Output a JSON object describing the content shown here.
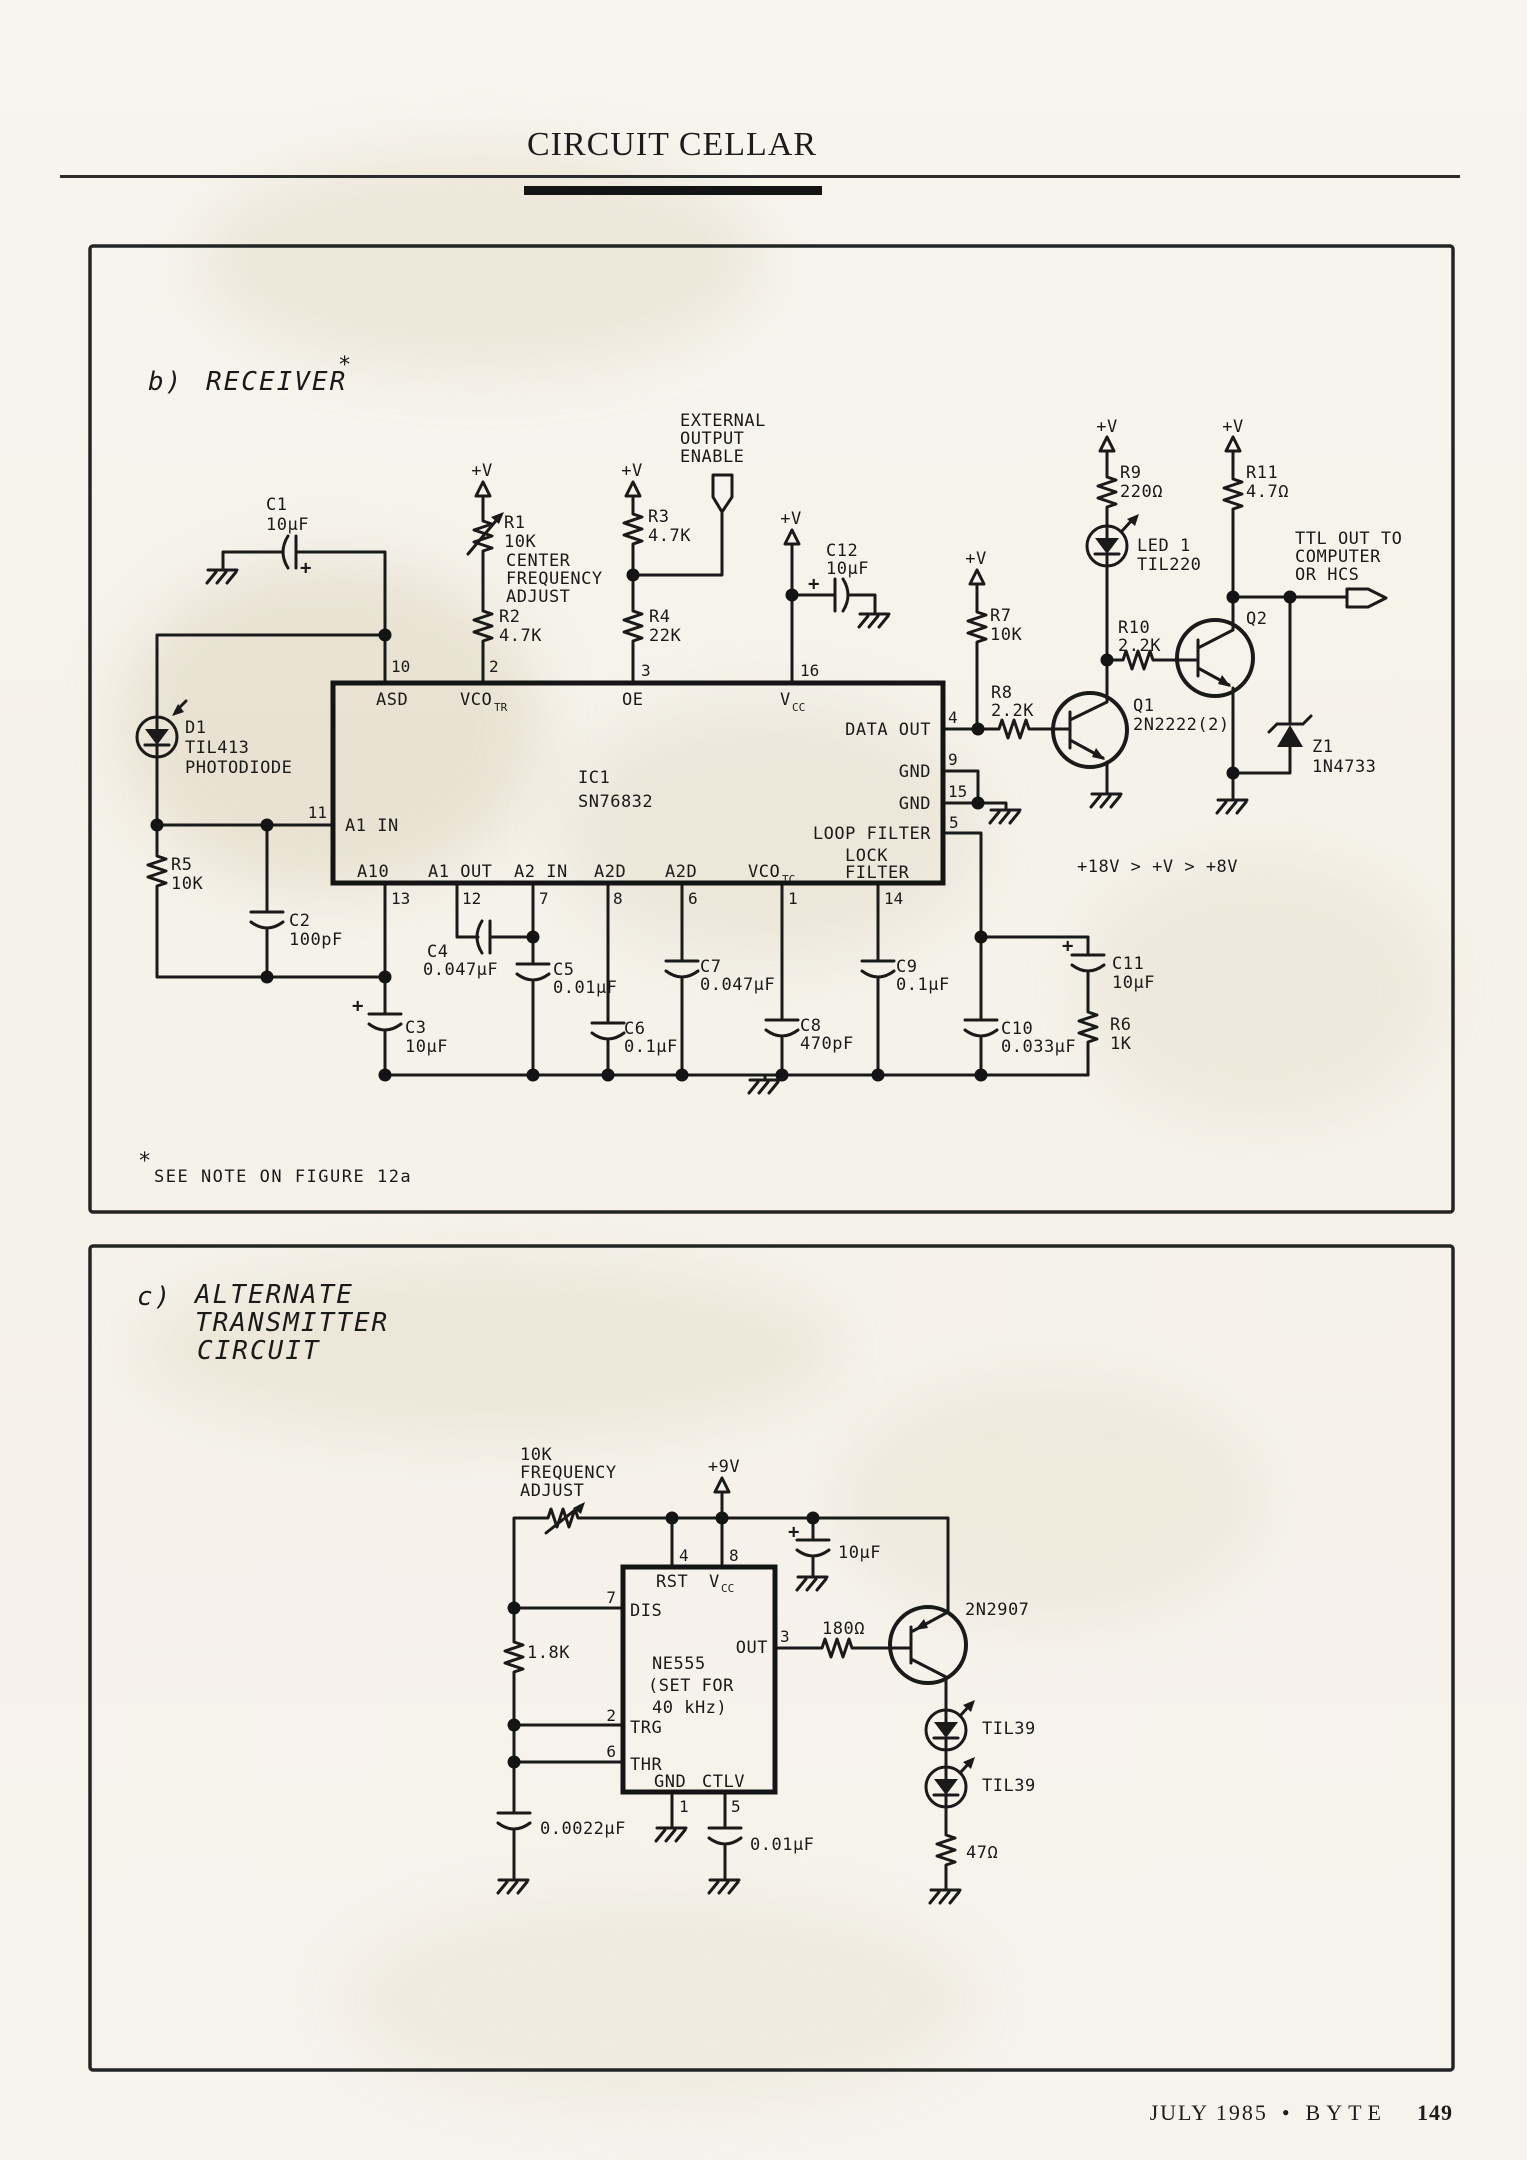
{
  "header": {
    "title": "CIRCUIT CELLAR"
  },
  "footer": {
    "issue": "JULY 1985",
    "bullet": "•",
    "magazine": "BYTE",
    "page": "149"
  },
  "shared": {
    "plus_v": "+V",
    "plus": "+"
  },
  "rx": {
    "title_prefix": "b)",
    "title": "RECEIVER",
    "star": "*",
    "note_star": "*",
    "note": "SEE NOTE ON FIGURE 12a",
    "voltage_note": "+18V > +V > +8V",
    "enable1": "EXTERNAL",
    "enable2": "OUTPUT",
    "enable3": "ENABLE",
    "ttl1": "TTL OUT TO",
    "ttl2": "COMPUTER",
    "ttl3": "OR HCS",
    "ic_ref": "IC1",
    "ic_part": "SN76832",
    "pn": {
      "p10": "10",
      "p2": "2",
      "p3": "3",
      "p16": "16",
      "p11": "11",
      "p4": "4",
      "p9": "9",
      "p15": "15",
      "p5": "5",
      "p13": "13",
      "p12": "12",
      "p7": "7",
      "p8": "8",
      "p6": "6",
      "p1": "1",
      "p14": "14"
    },
    "pl": {
      "asd": "ASD",
      "vco": "VCO",
      "tr": "TR",
      "oe": "OE",
      "v": "V",
      "cc": "CC",
      "a1in": "A1 IN",
      "dataout": "DATA OUT",
      "gnd": "GND",
      "loop": "LOOP FILTER",
      "lock1": "LOCK",
      "lock2": "FILTER",
      "a10": "A10",
      "a1out": "A1 OUT",
      "a2in": "A2 IN",
      "a2d": "A2D",
      "tc": "TC"
    },
    "c1": {
      "r": "C1",
      "v": "10μF"
    },
    "r1": {
      "r": "R1",
      "v": "10K",
      "n1": "CENTER",
      "n2": "FREQUENCY",
      "n3": "ADJUST"
    },
    "r2": {
      "r": "R2",
      "v": "4.7K"
    },
    "r3": {
      "r": "R3",
      "v": "4.7K"
    },
    "r4": {
      "r": "R4",
      "v": "22K"
    },
    "c12": {
      "r": "C12",
      "v": "10μF"
    },
    "r7": {
      "r": "R7",
      "v": "10K"
    },
    "r8": {
      "r": "R8",
      "v": "2.2K"
    },
    "r9": {
      "r": "R9",
      "v": "220Ω"
    },
    "r10": {
      "r": "R10",
      "v": "2.2K"
    },
    "r11": {
      "r": "R11",
      "v": "4.7Ω"
    },
    "led1": {
      "r": "LED 1",
      "v": "TIL220"
    },
    "q1": {
      "r": "Q1",
      "v": "2N2222(2)"
    },
    "q2": {
      "r": "Q2"
    },
    "z1": {
      "r": "Z1",
      "v": "1N4733"
    },
    "d1": {
      "r": "D1",
      "v": "TIL413",
      "n": "PHOTODIODE"
    },
    "r5": {
      "r": "R5",
      "v": "10K"
    },
    "c2": {
      "r": "C2",
      "v": "100pF"
    },
    "c3": {
      "r": "C3",
      "v": "10μF"
    },
    "c4": {
      "r": "C4",
      "v": "0.047μF"
    },
    "c5": {
      "r": "C5",
      "v": "0.01μF"
    },
    "c6": {
      "r": "C6",
      "v": "0.1μF"
    },
    "c7": {
      "r": "C7",
      "v": "0.047μF"
    },
    "c8": {
      "r": "C8",
      "v": "470pF"
    },
    "c9": {
      "r": "C9",
      "v": "0.1μF"
    },
    "c10": {
      "r": "C10",
      "v": "0.033μF"
    },
    "c11": {
      "r": "C11",
      "v": "10μF"
    },
    "r6": {
      "r": "R6",
      "v": "1K"
    }
  },
  "tx": {
    "title_prefix": "c)",
    "title1": "ALTERNATE",
    "title2": "TRANSMITTER",
    "title3": "CIRCUIT",
    "pot1": "10K",
    "pot2": "FREQUENCY",
    "pot3": "ADJUST",
    "supply": "+9V",
    "ic": "NE555",
    "ic_n1": "(SET FOR",
    "ic_n2": "40 kHz)",
    "pn": {
      "p4": "4",
      "p8": "8",
      "p7": "7",
      "p3": "3",
      "p2": "2",
      "p6": "6",
      "p1": "1",
      "p5": "5"
    },
    "pl": {
      "rst": "RST",
      "v": "V",
      "cc": "CC",
      "dis": "DIS",
      "out": "OUT",
      "trg": "TRG",
      "thr": "THR",
      "gnd": "GND",
      "ctlv": "CTLV"
    },
    "r18k": "1.8K",
    "c10uf": "10μF",
    "r180": "180Ω",
    "q": "2N2907",
    "led": "TIL39",
    "r47": "47Ω",
    "c0022": "0.0022μF",
    "c001": "0.01μF"
  }
}
